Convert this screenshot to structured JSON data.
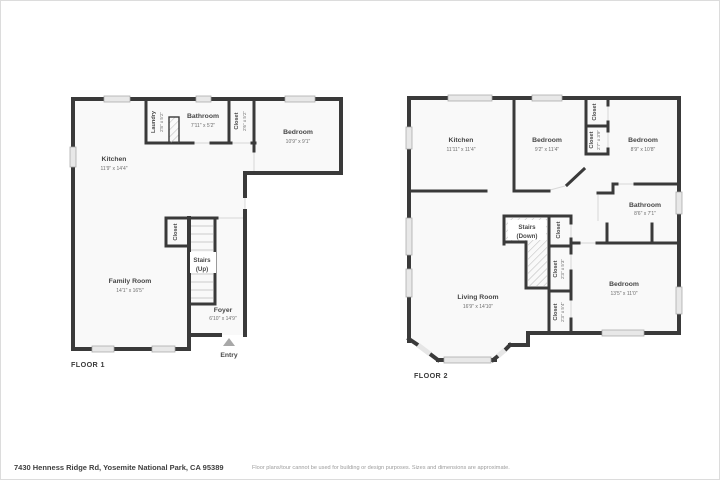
{
  "footer": {
    "address": "7430 Henness Ridge Rd, Yosemite National Park, CA 95389",
    "disclaimer": "Floor plans/tour cannot be used for building or design purposes. Sizes and dimensions are approximate."
  },
  "colors": {
    "wall": "#3a3a3a",
    "window": "#e8e8e8",
    "room_fill": "#f9f9f9",
    "text": "#474747",
    "entry_arrow": "#a8a8a8"
  },
  "floor1": {
    "label": "FLOOR 1",
    "rooms": {
      "kitchen": {
        "name": "Kitchen",
        "dims": "11'9\" x 14'4\""
      },
      "laundry": {
        "name": "Laundry",
        "dims": "2'8\" x 5'2\""
      },
      "bathroom": {
        "name": "Bathroom",
        "dims": "7'11\" x 5'2\""
      },
      "closet_hall": {
        "name": "Closet",
        "dims": "2'6\" x 5'2\""
      },
      "bedroom": {
        "name": "Bedroom",
        "dims": "10'9\" x 9'1\""
      },
      "family_room": {
        "name": "Family Room",
        "dims": "14'1\" x 16'5\""
      },
      "stairs": {
        "line1": "Stairs",
        "line2": "(Up)"
      },
      "closet_stairs": {
        "name": "Closet"
      },
      "foyer": {
        "name": "Foyer",
        "dims": "6'10\" x 14'9\""
      },
      "entry": {
        "name": "Entry"
      }
    }
  },
  "floor2": {
    "label": "FLOOR 2",
    "rooms": {
      "kitchen": {
        "name": "Kitchen",
        "dims": "11'11\" x 11'4\""
      },
      "bedroom_mid": {
        "name": "Bedroom",
        "dims": "9'2\" x 11'4\""
      },
      "bedroom_right": {
        "name": "Bedroom",
        "dims": "8'9\" x 10'8\""
      },
      "closet_top": {
        "name": "Closet"
      },
      "closet_small": {
        "name": "Closet",
        "dims": "2'7\" x 3'9\""
      },
      "bathroom": {
        "name": "Bathroom",
        "dims": "8'6\" x 7'1\""
      },
      "stairs": {
        "line1": "Stairs",
        "line2": "(Down)"
      },
      "closet_hall_top": {
        "name": "Closet"
      },
      "closet_hall_mid": {
        "name": "Closet",
        "dims": "2'3\" x 5'3\""
      },
      "closet_hall_bot": {
        "name": "Closet",
        "dims": "2'3\" x 5'4\""
      },
      "living_room": {
        "name": "Living Room",
        "dims": "16'9\" x 14'10\""
      },
      "bedroom_bottom": {
        "name": "Bedroom",
        "dims": "13'5\" x 11'0\""
      }
    }
  }
}
